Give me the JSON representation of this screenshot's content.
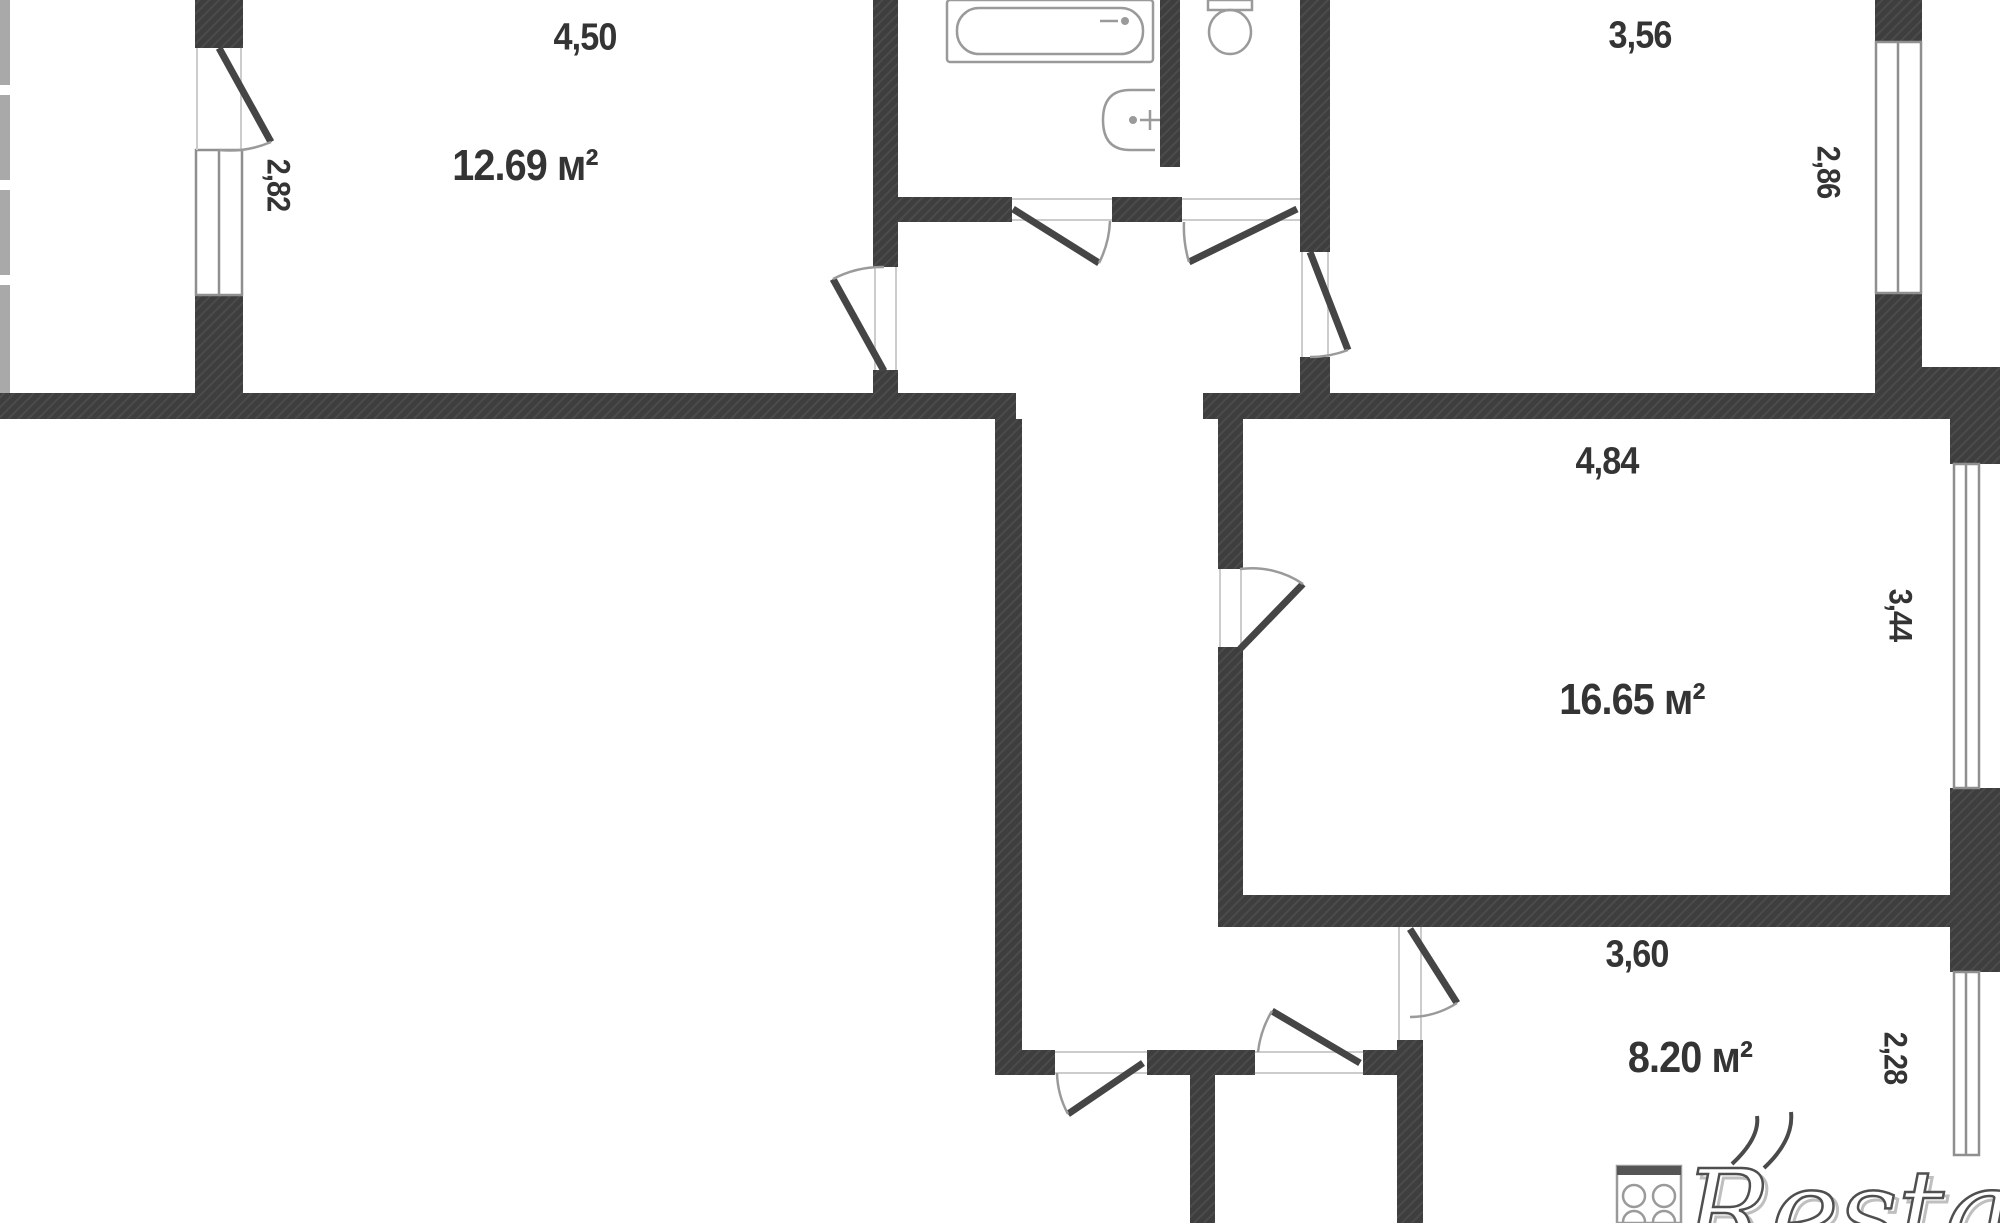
{
  "floor_plan": {
    "description": "apartment floor plan fragment",
    "rooms": [
      {
        "id": "room-top-left",
        "area_label": "12.69 м²",
        "width_label": "4,50",
        "window_label": "2,82"
      },
      {
        "id": "bathroom",
        "fixtures": [
          "bathtub",
          "sink"
        ]
      },
      {
        "id": "wc",
        "fixtures": [
          "toilet"
        ]
      },
      {
        "id": "room-top-right",
        "width_label": "3,56",
        "window_label": "2,86"
      },
      {
        "id": "room-middle-right",
        "area_label": "16.65 м²",
        "width_label": "4,84",
        "window_label": "3,44"
      },
      {
        "id": "kitchen",
        "area_label": "8.20 м²",
        "width_label": "3,60",
        "window_label": "2,28",
        "fixtures": [
          "stove"
        ]
      }
    ],
    "labels": {
      "dim_450": "4,50",
      "area_1269": "12.69 м²",
      "dim_282": "2,82",
      "dim_356": "3,56",
      "dim_286": "2,86",
      "dim_484": "4,84",
      "area_1665": "16.65 м²",
      "dim_344": "3,44",
      "dim_360": "3,60",
      "area_820": "8.20 м²",
      "dim_228": "2,28"
    },
    "watermark": {
      "text": "Restate"
    },
    "colors": {
      "wall": "#3e3e3e",
      "fixture_line": "#9a9a9a",
      "door_leaf": "#454545",
      "label_text": "#343434",
      "background": "#ffffff"
    }
  }
}
